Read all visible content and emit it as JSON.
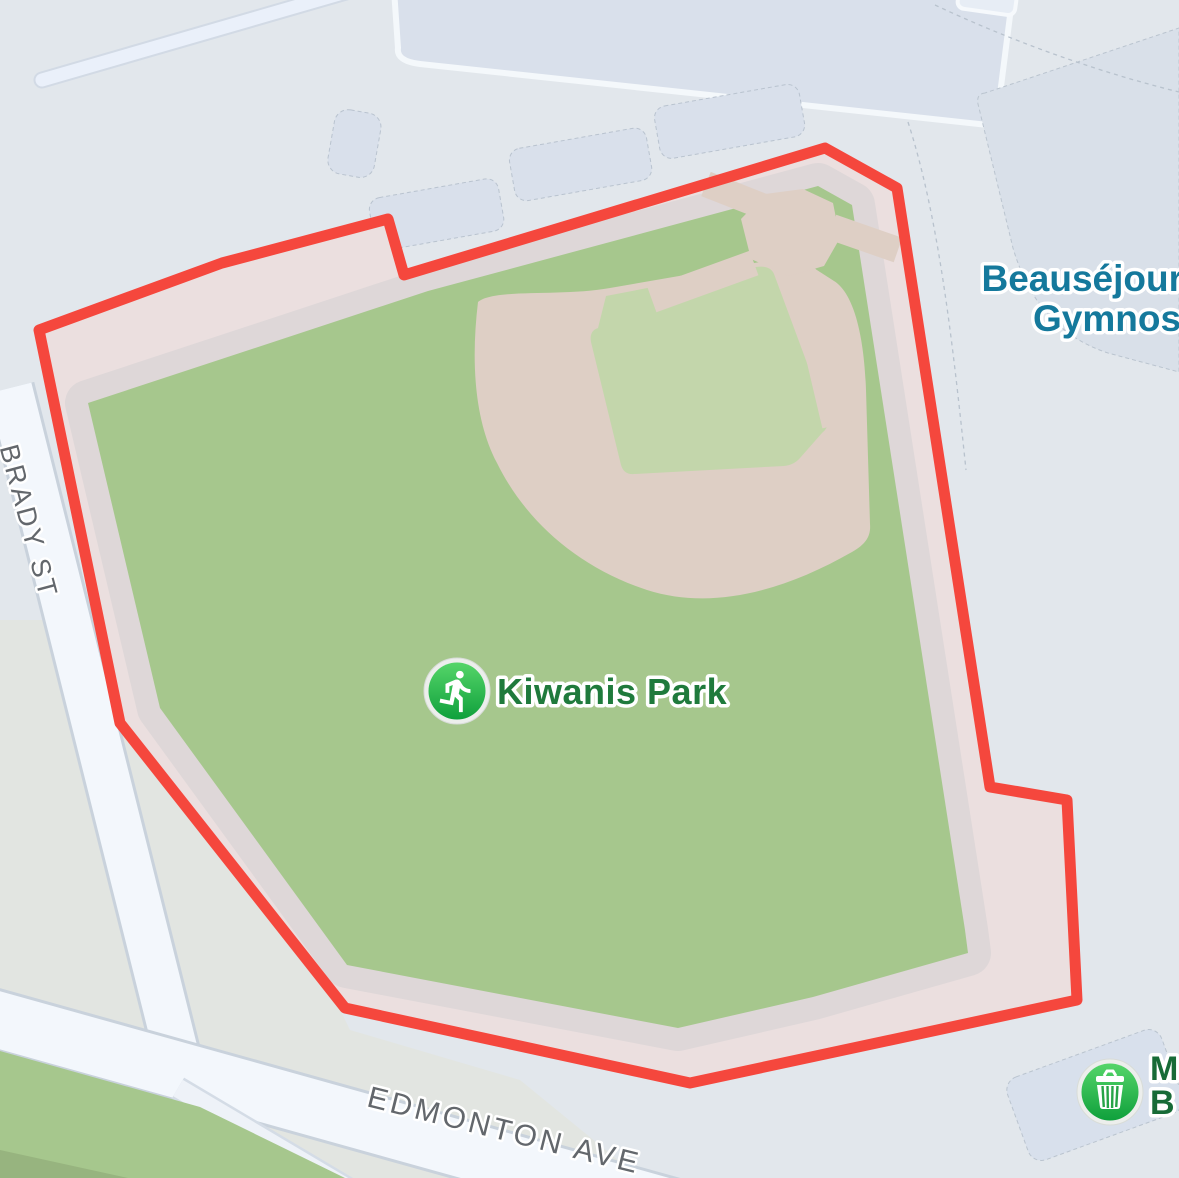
{
  "map": {
    "park": {
      "label": "Kiwanis Park",
      "icon": "runner-icon"
    },
    "poi_top_right": {
      "line1": "Beauséjour",
      "line2": "Gymnos"
    },
    "poi_bottom_right": {
      "line1": "M",
      "line2": "B",
      "icon": "waste-basket-icon"
    },
    "streets": [
      {
        "name": "BRADY ST"
      },
      {
        "name": "EDMONTON AVE"
      }
    ],
    "colors": {
      "boundary_red": "#f5473d",
      "grass": "#a6c78d",
      "infield_green": "#c3d6ab",
      "dirt_path": "#decfc5",
      "band_pink": "#ebdfdf",
      "band_gray": "#ded7d8",
      "road_fill": "#f3f7fc",
      "road_border": "#c9d2dc",
      "block": "#e2e7ec",
      "block_green": "#e2e5e1",
      "patch_green_dark": "#97b47f",
      "building": "#d9e0eb",
      "building_stroke": "#b9c3cf",
      "park_label_text": "#1f7a3c",
      "poi_blue_text": "#15799c",
      "poi_green_text": "#176b37",
      "street_text": "#63676c",
      "icon_green_light": "#55d569",
      "icon_green_dark": "#0fa03c"
    }
  }
}
